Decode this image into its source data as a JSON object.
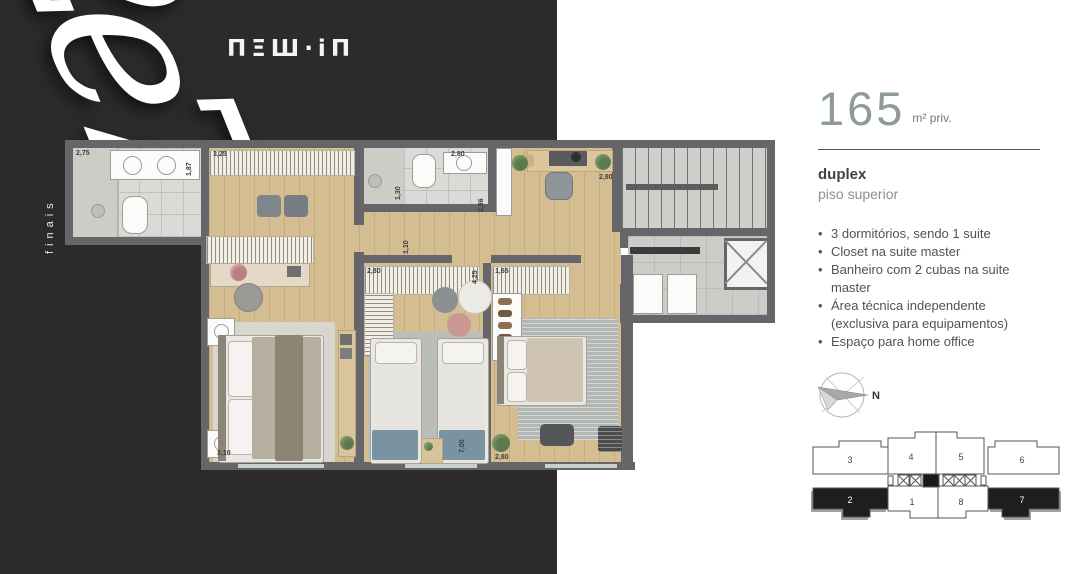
{
  "brand": {
    "logo_text": "ΠΞШ·iΠ"
  },
  "hero": {
    "script_text": "2e7",
    "vertical_label": "finais"
  },
  "spec": {
    "area_value": "165",
    "area_unit": "m² priv.",
    "type_label": "duplex",
    "floor_label": "piso superior",
    "features": [
      {
        "bullet": "•",
        "text": "3 dormitórios, sendo 1 suite"
      },
      {
        "bullet": "•",
        "text": "Closet na suite master"
      },
      {
        "bullet": "•",
        "text": "Banheiro com 2 cubas na suite master"
      },
      {
        "bullet": "•",
        "text": "Área técnica independente"
      },
      {
        "bullet": "",
        "text": "(exclusiva para equipamentos)"
      },
      {
        "bullet": "•",
        "text": "Espaço para home office"
      }
    ]
  },
  "plan": {
    "dims": [
      "2,75",
      "1,87",
      "3,25",
      "2,80",
      "1,30",
      "2,86",
      "2,80",
      "1,10",
      "2,80",
      "4,25",
      "1,65",
      "3,10",
      "7,00",
      "2,80"
    ]
  },
  "compass": {
    "north": "N"
  },
  "keyplan": {
    "units": {
      "n1": "1",
      "n2": "2",
      "n3": "3",
      "n4": "4",
      "n5": "5",
      "n6": "6",
      "n7": "7",
      "n8": "8"
    },
    "highlighted_units": "2 e 7"
  },
  "colors": {
    "dark_panel": "#2b2b2a",
    "wall": "#66666a",
    "wood_floor": "#d5bd92",
    "keyplan_highlight": "#1e1e1e"
  }
}
